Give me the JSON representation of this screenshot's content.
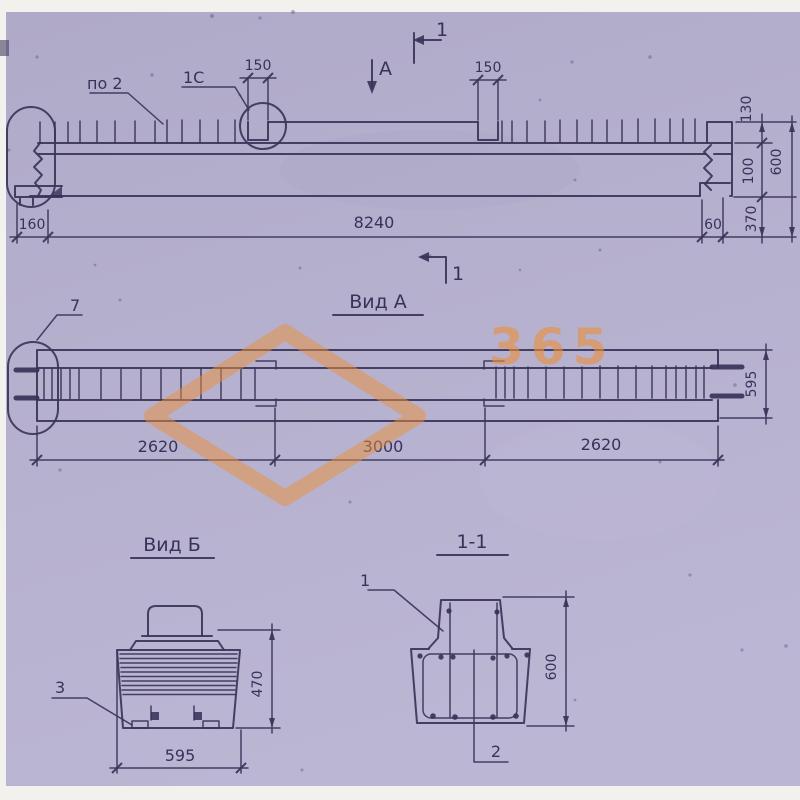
{
  "colors": {
    "paper": "#b4afcc",
    "ink": "#3a3459",
    "margin_white": "#f2f1ed",
    "watermark_orange": "#ec8f3a"
  },
  "watermark": {
    "number": "365"
  },
  "elevation": {
    "label_po2": "по 2",
    "label_1c": "1С",
    "view_arrow_label": "А",
    "section_mark_top": "1",
    "section_mark_bottom": "1",
    "dim_notch_left": "150",
    "dim_notch_right": "150",
    "dim_end_left": "160",
    "dim_total": "8240",
    "dim_end_right": "60",
    "dim_top_offset": "130",
    "dim_mid_offset": "100",
    "dim_bottom_offset": "370",
    "dim_height": "600"
  },
  "view_a": {
    "title": "Вид А",
    "detail_label": "7",
    "dim_segment_left": "2620",
    "dim_segment_mid": "3000",
    "dim_segment_right": "2620",
    "dim_width": "595"
  },
  "view_b": {
    "title": "Вид Б",
    "detail_label": "3",
    "dim_width": "595",
    "dim_height": "470"
  },
  "section_1_1": {
    "title": "1-1",
    "callout_top": "1",
    "callout_bottom": "2",
    "dim_height": "600"
  }
}
